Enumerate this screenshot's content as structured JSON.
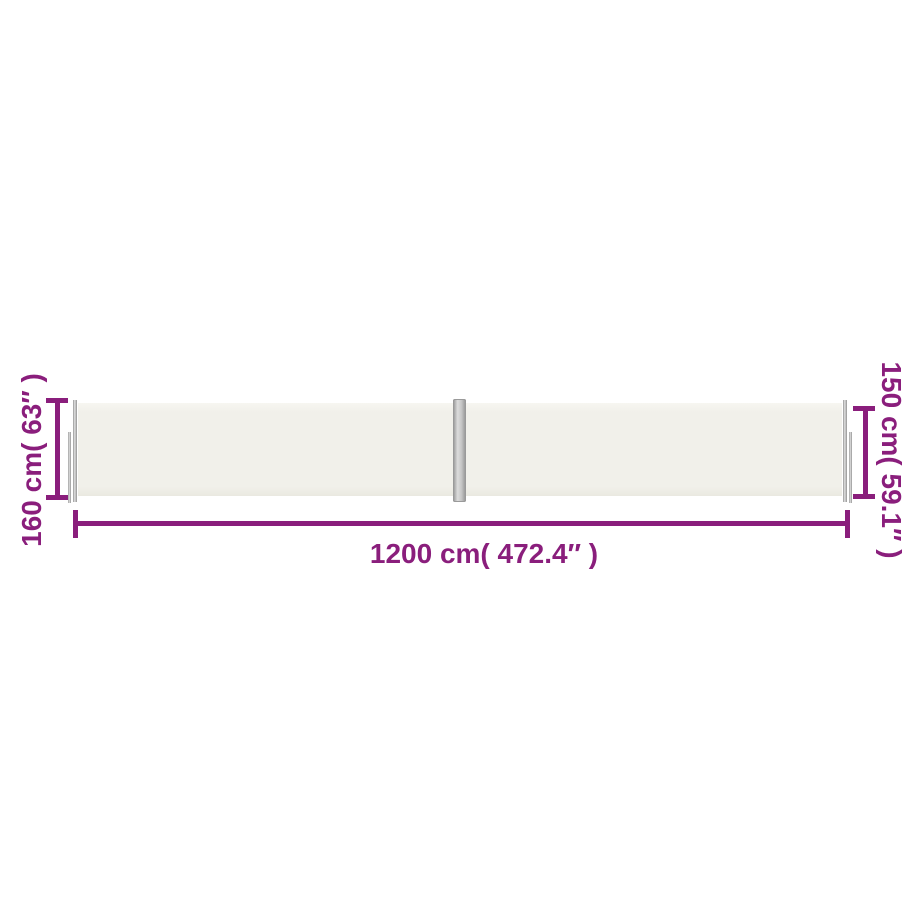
{
  "diagram": {
    "type": "product-dimension-diagram",
    "subject": "retractable double side awning",
    "dimensions": {
      "left_height_label": "160 cm( 63″ )",
      "right_height_label": "150 cm( 59.1″ )",
      "bottom_width_label": "1200 cm( 472.4″ )"
    }
  },
  "colors": {
    "accent": "#8a1e7c",
    "background": "#ffffff",
    "fabric": "#f1f0ea",
    "fabric-edge": "#eae9e1",
    "pole-light": "#dcdcdc",
    "pole-dark": "#909090"
  }
}
